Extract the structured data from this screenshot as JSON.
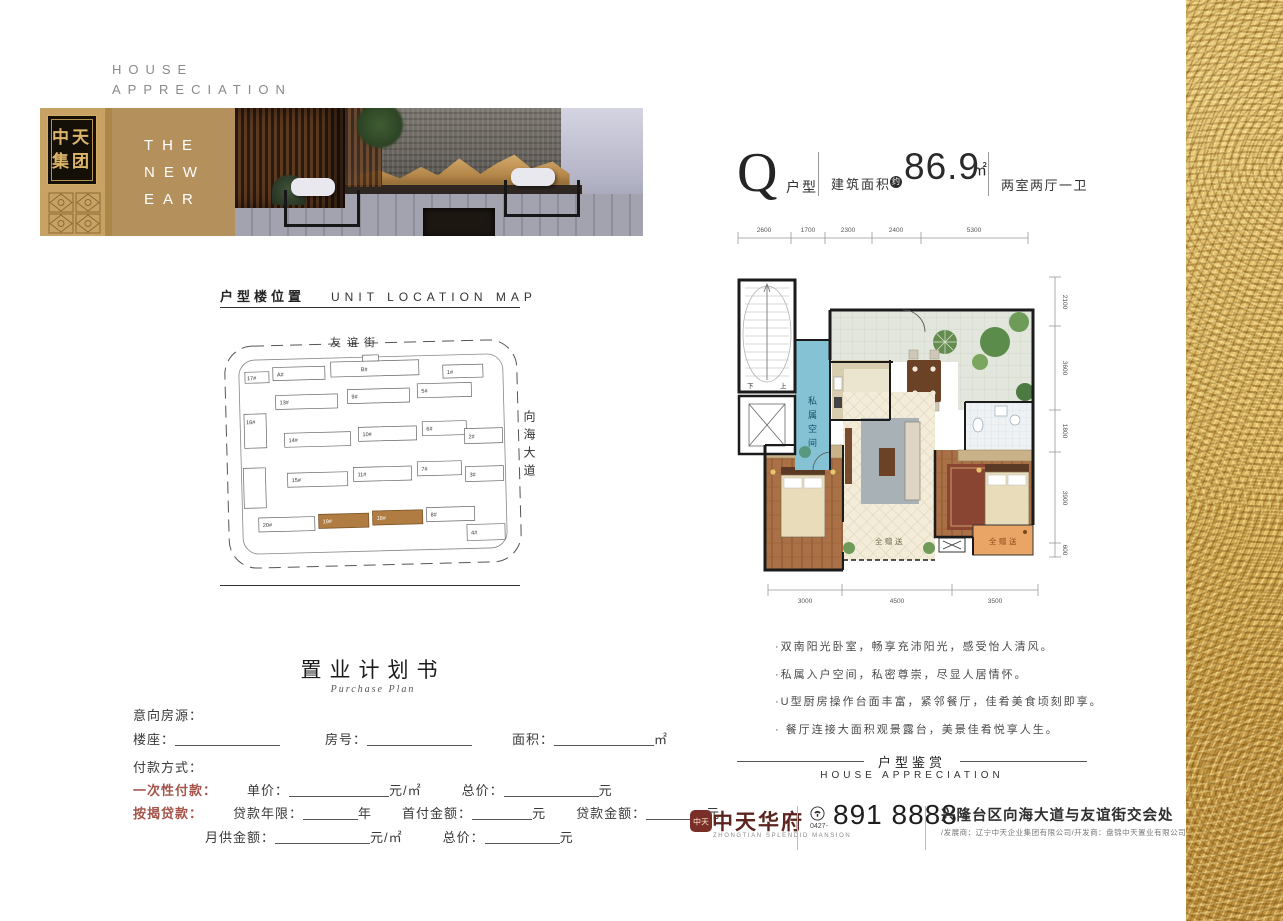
{
  "header": {
    "line1": "HOUSE",
    "line2": "APPRECIATION"
  },
  "brand_block": {
    "logo": [
      "中天",
      "集团"
    ],
    "banner": [
      "THE",
      "NEW",
      "EAR"
    ]
  },
  "unit": {
    "letter": "Q",
    "type": "户型",
    "area_label": "建筑面积",
    "approx": "约",
    "area": "86.9",
    "sqm": "㎡",
    "rooms": "两室两厅一卫"
  },
  "floorplan": {
    "dims_top": [
      "2600",
      "1700",
      "2300",
      "2400",
      "5300"
    ],
    "dims_right": [
      "2100",
      "3600",
      "1800",
      "3900",
      "600"
    ],
    "dims_bottom": [
      "3000",
      "4500",
      "3500"
    ],
    "private_space": "私属空间",
    "gift": "全赠送",
    "stair_down": "下",
    "stair_up": "上"
  },
  "location_map": {
    "title_cn": "户型楼位置",
    "title_en": "UNIT LOCATION MAP",
    "street_top": "友谊街",
    "street_right": "向海大道",
    "buildings": [
      {
        "label": "A#"
      },
      {
        "label": "B#"
      },
      {
        "label": "1#"
      },
      {
        "label": "17#"
      },
      {
        "label": "13#"
      },
      {
        "label": "9#"
      },
      {
        "label": "5#"
      },
      {
        "label": "16#"
      },
      {
        "label": "14#"
      },
      {
        "label": "10#"
      },
      {
        "label": "6#"
      },
      {
        "label": "2#"
      },
      {
        "label": "15#"
      },
      {
        "label": "11#"
      },
      {
        "label": "7#"
      },
      {
        "label": "3#"
      },
      {
        "label": "20#"
      },
      {
        "label": "19#",
        "highlight": true
      },
      {
        "label": "18#",
        "highlight": true
      },
      {
        "label": "8#"
      },
      {
        "label": "4#"
      }
    ],
    "highlight_color": "#b07c42"
  },
  "notes": [
    "·双南阳光卧室，畅享充沛阳光，感受怡人清风。",
    "·私属入户空间，私密尊崇，尽显人居情怀。",
    "·U型厨房操作台面丰富，紧邻餐厅，佳肴美食顷刻即享。",
    "· 餐厅连接大面积观景露台，美景佳肴悦享人生。"
  ],
  "purchase_plan": {
    "title": "置业计划书",
    "subtitle": "Purchase Plan",
    "intent": "意向房源：",
    "block": "楼座：",
    "room": "房号：",
    "area": "面积：",
    "sqm": "㎡",
    "payment": "付款方式：",
    "one_time": "一次性付款：",
    "unit_price": "单价：",
    "per_sqm": "元/㎡",
    "total": "总价：",
    "yuan": "元",
    "mortgage": "按揭贷款：",
    "years": "贷款年限：",
    "year": "年",
    "down_payment": "首付金额：",
    "loan": "贷款金额：",
    "monthly": "月供金额："
  },
  "footer": {
    "section_cn": "户型鉴赏",
    "section_en": "HOUSE APPRECIATION",
    "seal": "中天",
    "brand": "中天华府",
    "brand_en": "ZHONGTIAN SPLENDID MANSION",
    "phone_prefix": "0427-",
    "phone": "891 8888",
    "address": "兴隆台区向海大道与友谊街交会处",
    "developers": "/发展商：辽宁中天企业集团有限公司/开发商：盘锦中天置业有限公司"
  }
}
